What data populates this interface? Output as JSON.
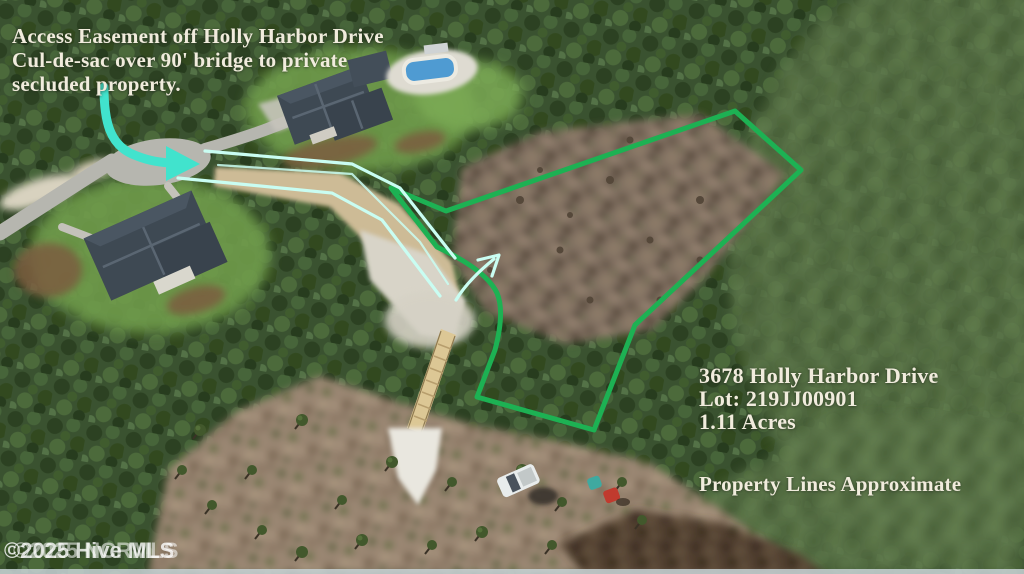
{
  "scene": {
    "type": "aerial-drone-photo",
    "subject": "wooded residential lot with highlighted access easement and property boundary"
  },
  "annotations": {
    "access_note_line1": "Access Easement off Holly Harbor Drive",
    "access_note_line2": "Cul-de-sac over 90' bridge to private",
    "access_note_line3": "secluded property.",
    "address_line1": "3678 Holly Harbor Drive",
    "address_line2": "Lot: 219JJ00901",
    "address_line3": "1.11 Acres",
    "disclaimer": "Property Lines Approximate",
    "watermark_front": "©2025 Hive MLS",
    "watermark_back": "©2025 NCRMLS"
  },
  "colors": {
    "boundary_green": "#1db153",
    "easement_teal": "#41e3cd",
    "easement_light_cyan": "#c9fdf2",
    "label_text": "#f1ecdd",
    "watermark_text": "#ffffff"
  }
}
